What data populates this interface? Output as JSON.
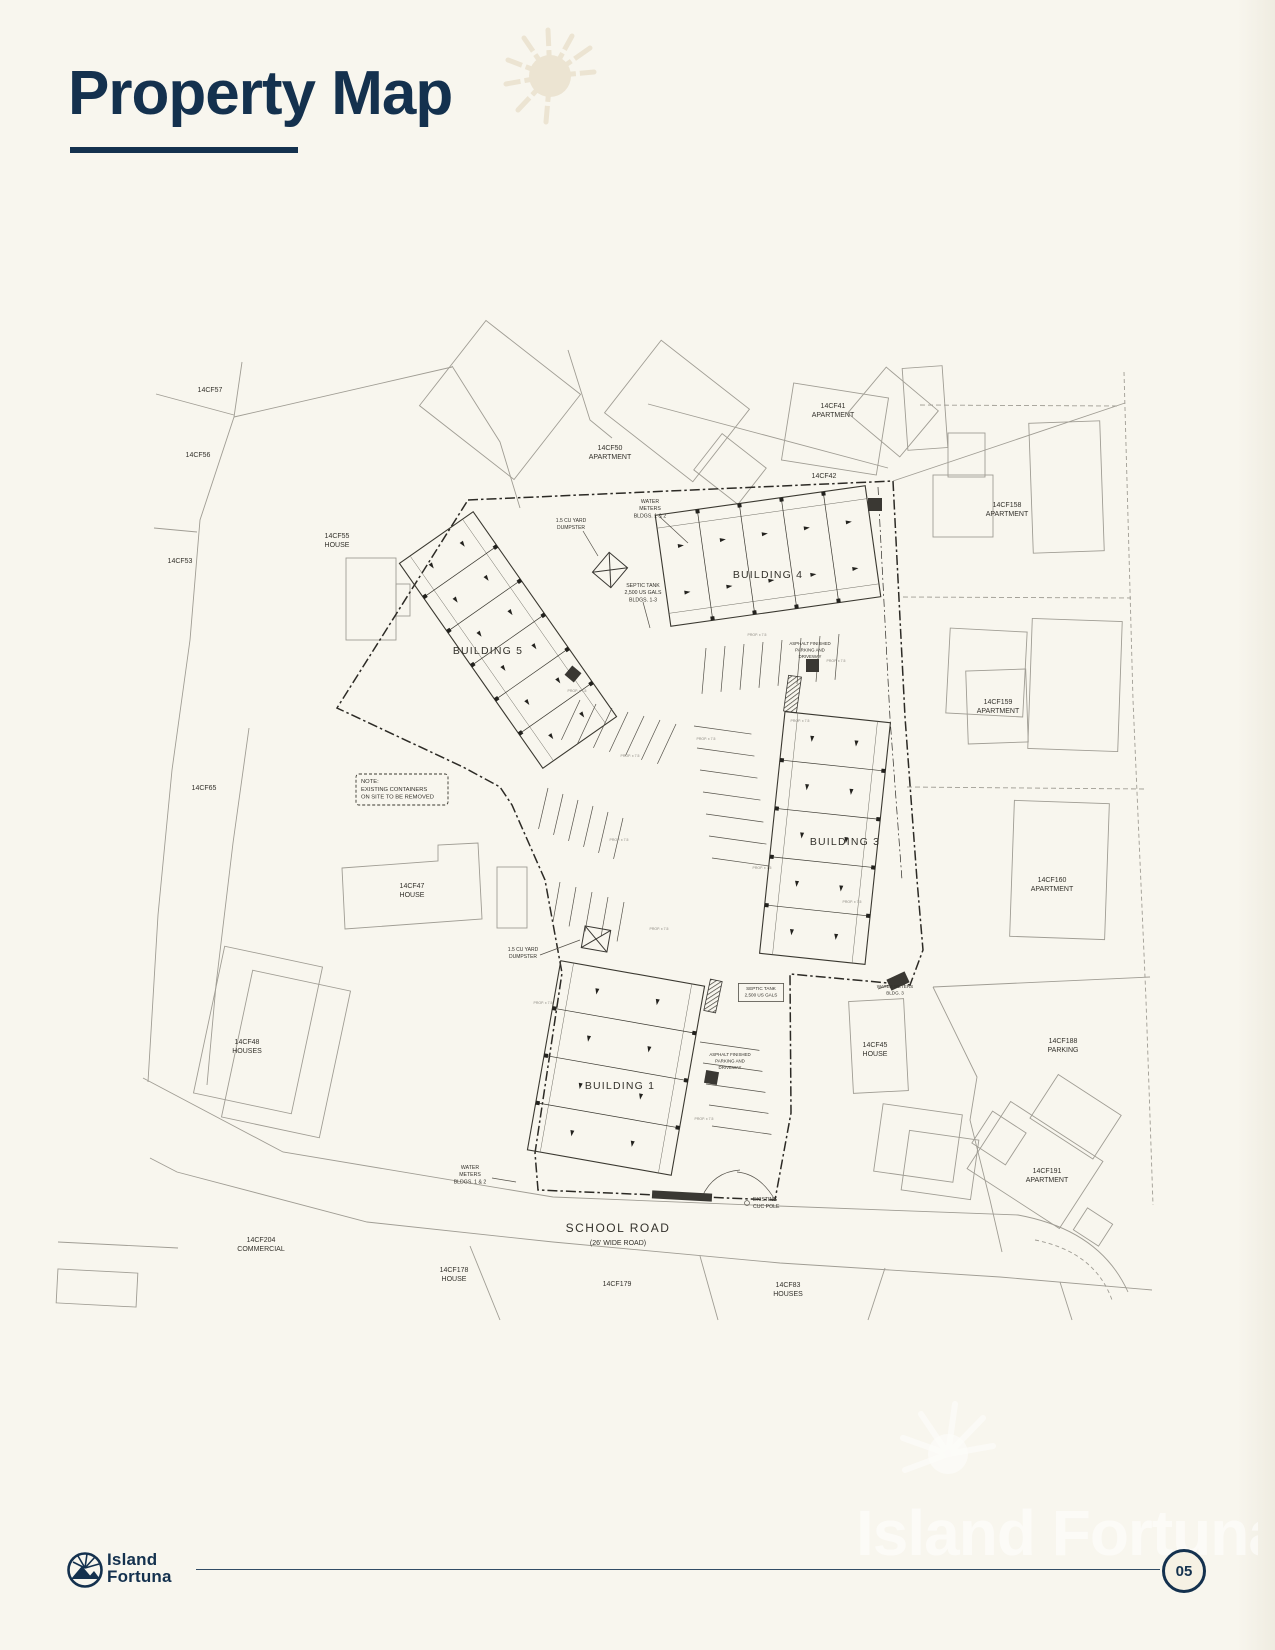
{
  "header": {
    "title": "Property Map"
  },
  "colors": {
    "navy": "#14314e",
    "background": "#f8f6ee",
    "line_light": "#a09d94",
    "line_dark": "#2c2a25"
  },
  "watermark": {
    "text": "Island Fortuna"
  },
  "footer": {
    "brand_line1": "Island",
    "brand_line2": "Fortuna",
    "page_number": "05"
  },
  "map": {
    "road": {
      "name": "SCHOOL ROAD",
      "sub": "(26' WIDE ROAD)"
    },
    "micro_label": "PROP. x 7.5",
    "micro": [
      [
        577,
        692
      ],
      [
        630,
        757
      ],
      [
        706,
        740
      ],
      [
        800,
        722
      ],
      [
        659,
        930
      ],
      [
        704,
        1120
      ],
      [
        852,
        903
      ],
      [
        757,
        636
      ],
      [
        619,
        841
      ],
      [
        543,
        1004
      ],
      [
        836,
        662
      ],
      [
        762,
        869
      ]
    ],
    "labels": [
      {
        "n": "parcel-label-14cf57",
        "l": [
          "14CF57"
        ],
        "x": 210,
        "y": 392,
        "s": 7
      },
      {
        "n": "parcel-label-14cf56",
        "l": [
          "14CF56"
        ],
        "x": 198,
        "y": 457,
        "s": 7
      },
      {
        "n": "parcel-label-14cf53",
        "l": [
          "14CF53"
        ],
        "x": 180,
        "y": 563,
        "s": 7
      },
      {
        "n": "parcel-label-14cf55",
        "l": [
          "14CF55",
          "HOUSE"
        ],
        "x": 337,
        "y": 538,
        "s": 7
      },
      {
        "n": "parcel-label-14cf50",
        "l": [
          "14CF50",
          "APARTMENT"
        ],
        "x": 610,
        "y": 450,
        "s": 7
      },
      {
        "n": "parcel-label-14cf41",
        "l": [
          "14CF41",
          "APARTMENT"
        ],
        "x": 833,
        "y": 408,
        "s": 7
      },
      {
        "n": "parcel-label-14cf42",
        "l": [
          "14CF42"
        ],
        "x": 824,
        "y": 478,
        "s": 7
      },
      {
        "n": "parcel-label-14cf158",
        "l": [
          "14CF158",
          "APARTMENT"
        ],
        "x": 1007,
        "y": 507,
        "s": 7
      },
      {
        "n": "parcel-label-14cf159",
        "l": [
          "14CF159",
          "APARTMENT"
        ],
        "x": 998,
        "y": 704,
        "s": 7
      },
      {
        "n": "parcel-label-14cf160",
        "l": [
          "14CF160",
          "APARTMENT"
        ],
        "x": 1052,
        "y": 882,
        "s": 7
      },
      {
        "n": "parcel-label-14cf65",
        "l": [
          "14CF65"
        ],
        "x": 204,
        "y": 790,
        "s": 7
      },
      {
        "n": "parcel-label-14cf47",
        "l": [
          "14CF47",
          "HOUSE"
        ],
        "x": 412,
        "y": 888,
        "s": 7
      },
      {
        "n": "parcel-label-14cf48",
        "l": [
          "14CF48",
          "HOUSES"
        ],
        "x": 247,
        "y": 1044,
        "s": 7
      },
      {
        "n": "parcel-label-14cf204",
        "l": [
          "14CF204",
          "COMMERCIAL"
        ],
        "x": 261,
        "y": 1242,
        "s": 7
      },
      {
        "n": "parcel-label-14cf178",
        "l": [
          "14CF178",
          "HOUSE"
        ],
        "x": 454,
        "y": 1272,
        "s": 7
      },
      {
        "n": "parcel-label-14cf179",
        "l": [
          "14CF179"
        ],
        "x": 617,
        "y": 1286,
        "s": 7
      },
      {
        "n": "parcel-label-14cf83",
        "l": [
          "14CF83",
          "HOUSES"
        ],
        "x": 788,
        "y": 1287,
        "s": 7
      },
      {
        "n": "parcel-label-14cf45",
        "l": [
          "14CF45",
          "HOUSE"
        ],
        "x": 875,
        "y": 1047,
        "s": 7
      },
      {
        "n": "parcel-label-14cf188",
        "l": [
          "14CF188",
          "PARKING"
        ],
        "x": 1063,
        "y": 1043,
        "s": 7
      },
      {
        "n": "parcel-label-14cf191",
        "l": [
          "14CF191",
          "APARTMENT"
        ],
        "x": 1047,
        "y": 1173,
        "s": 7
      },
      {
        "n": "building-5-label",
        "l": [
          "BUILDING 5"
        ],
        "x": 488,
        "y": 654,
        "s": 10.5,
        "ls": 1.2
      },
      {
        "n": "building-4-label",
        "l": [
          "BUILDING 4"
        ],
        "x": 768,
        "y": 578,
        "s": 10.5,
        "ls": 1.2
      },
      {
        "n": "building-3-label",
        "l": [
          "BUILDING 3"
        ],
        "x": 845,
        "y": 845,
        "s": 10.5,
        "ls": 1.2
      },
      {
        "n": "building-1-label",
        "l": [
          "BUILDING 1"
        ],
        "x": 620,
        "y": 1089,
        "s": 10.5,
        "ls": 1.2
      },
      {
        "n": "water-meters-top-label",
        "l": [
          "WATER",
          "METERS",
          "BLDGS. 1 & 2"
        ],
        "x": 650,
        "y": 503,
        "s": 5.2
      },
      {
        "n": "dumpster-top-label",
        "l": [
          "1.5 CU YARD",
          "DUMPSTER"
        ],
        "x": 571,
        "y": 522,
        "s": 5
      },
      {
        "n": "septic-tank-top-label",
        "l": [
          "SEPTIC TANK",
          "2,500 US GALS",
          "BLDGS. 1-3"
        ],
        "x": 643,
        "y": 587,
        "s": 5.2
      },
      {
        "n": "asphalt-label-1",
        "l": [
          "ASPHALT FINISHED",
          "PARKING AND",
          "DRIVEWAY"
        ],
        "x": 810,
        "y": 645,
        "s": 4.4
      },
      {
        "n": "asphalt-label-2",
        "l": [
          "ASPHALT FINISHED",
          "PARKING AND",
          "DRIVEWAY"
        ],
        "x": 730,
        "y": 1056,
        "s": 4.4
      },
      {
        "n": "septic-tank-bottom-label",
        "l": [
          "SEPTIC TANK",
          "2,500 US GALS"
        ],
        "x": 761,
        "y": 990,
        "s": 4.6,
        "b": true
      },
      {
        "n": "dumpster-bottom-label",
        "l": [
          "1.5 CU YARD",
          "DUMPSTER"
        ],
        "x": 523,
        "y": 951,
        "s": 5
      },
      {
        "n": "water-meters-bldg3-label",
        "l": [
          "WATER METERS",
          "BLDG. 3"
        ],
        "x": 895,
        "y": 988,
        "s": 4.6
      },
      {
        "n": "water-meters-bottom-label",
        "l": [
          "WATER",
          "METERS",
          "BLDGS. 1 & 2"
        ],
        "x": 470,
        "y": 1169,
        "s": 5.2
      },
      {
        "n": "cuc-pole-label",
        "l": [
          "EXISTING",
          "CUC POLE"
        ],
        "x": 753,
        "y": 1201,
        "s": 5.2,
        "a": "s"
      },
      {
        "n": "school-road-label",
        "l": [
          "SCHOOL ROAD"
        ],
        "x": 618,
        "y": 1232,
        "s": 12,
        "ls": 1.5
      },
      {
        "n": "school-road-sub-label",
        "l": [
          "(26' WIDE ROAD)"
        ],
        "x": 618,
        "y": 1245,
        "s": 7
      },
      {
        "n": "containers-note",
        "l": [
          "NOTE:",
          "EXISTING CONTAINERS",
          "ON SITE TO BE REMOVED"
        ],
        "x": 361,
        "y": 783,
        "s": 5.8,
        "a": "s"
      }
    ]
  }
}
